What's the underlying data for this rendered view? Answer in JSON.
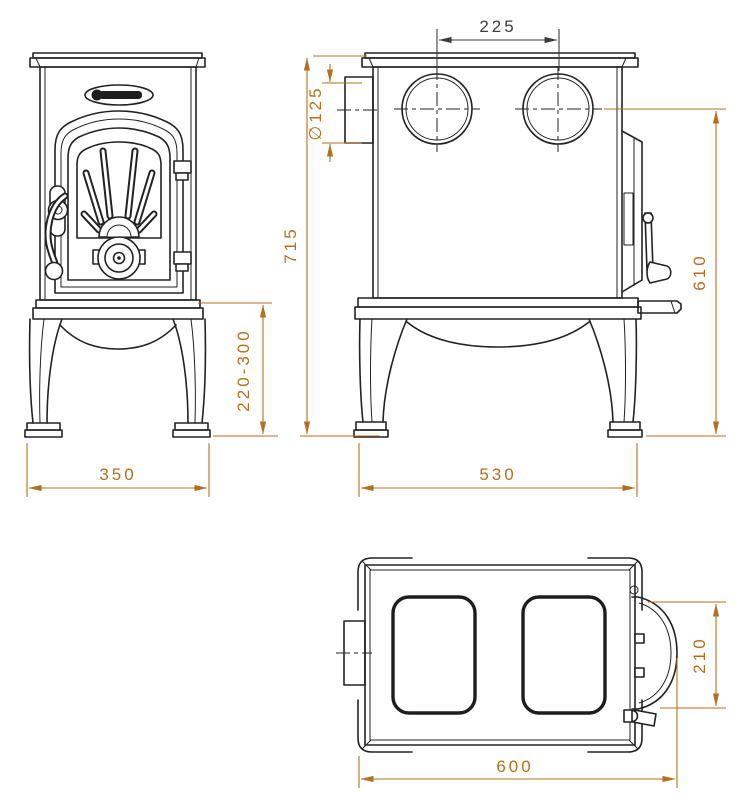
{
  "page": {
    "background": "#ffffff"
  },
  "colors": {
    "drawing_line": "#222222",
    "dimension_accent": "#b4701e",
    "dimension_dark": "#3d3d3d"
  },
  "dimensions": {
    "flue_outlet_spacing": "225",
    "flue_diameter": "∅125",
    "overall_height": "715",
    "flue_center_height": "610",
    "leg_height_range": "220-300",
    "front_width": "350",
    "base_depth": "530",
    "overall_depth": "600",
    "door_width_top": "210"
  }
}
